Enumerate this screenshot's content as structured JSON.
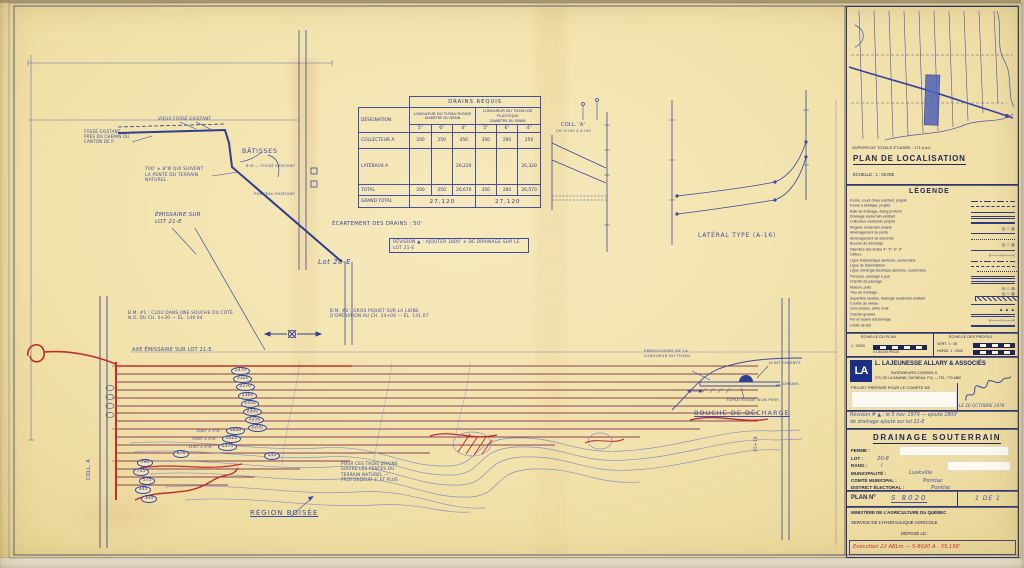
{
  "locator": {
    "superficie": "SUPERFICIE TOTALE ÉTUDIÉE : 171.4 AC.",
    "title": "PLAN DE LOCALISATION",
    "echelle": "ÉCHELLE : 1 : 50,000"
  },
  "legend": {
    "title": "LÉGENDE",
    "items": [
      {
        "label": "Fossé, cours d'eau existant, projeté",
        "symbol": "dashdot"
      },
      {
        "label": "Fossé à déblayer, projeté",
        "symbol": "dash"
      },
      {
        "label": "Raie de drainage, étang profond",
        "symbol": "solid"
      },
      {
        "label": "Drainage souterrain existant",
        "symbol": "double"
      },
      {
        "label": "Collecteur souterrain projeté",
        "symbol": "thick"
      },
      {
        "label": "Regard, souterrain projeté",
        "symbol": "circles"
      },
      {
        "label": "Aménagement de pente",
        "symbol": "solid"
      },
      {
        "label": "Aménagement de descente",
        "symbol": "dot"
      },
      {
        "label": "Bouche de décharge",
        "symbol": "circles"
      },
      {
        "label": "Diamètre des drains 4\", 5\", 6\", 8\"",
        "symbol": "solid"
      },
      {
        "label": "Clôture",
        "symbol": "x"
      },
      {
        "label": "Ligne téléphonique aérienne, souterraine",
        "symbol": "dashdot"
      },
      {
        "label": "Ligne de transmission",
        "symbol": "dash"
      },
      {
        "label": "Ligne d'énergie électrique aérienne, souterraine",
        "symbol": "dot"
      },
      {
        "label": "Ponceau, passage à gué",
        "symbol": "double"
      },
      {
        "label": "Chemin de passage",
        "symbol": "double"
      },
      {
        "label": "Maison, puits",
        "symbol": "circles"
      },
      {
        "label": "Trou de sondage",
        "symbol": "circles"
      },
      {
        "label": "Superficie étudiée, drainage souterrain existant",
        "symbol": "hatch"
      },
      {
        "label": "Courbe de niveau",
        "symbol": "solid"
      },
      {
        "label": "Zone boisée, arbre isolé",
        "symbol": "triangles"
      },
      {
        "label": "Chemin gravelé",
        "symbol": "double"
      },
      {
        "label": "Fer et repère d'arpentage",
        "symbol": "x"
      },
      {
        "label": "Limite de lots",
        "symbol": "thick"
      }
    ]
  },
  "scales": {
    "plan_label": "ÉCHELLE DU PLAN",
    "plan_ratio": "1 : 2000",
    "plan_units": "0     100    200 PIEDS",
    "prof_label": "ÉCHELLE DES PROFILS",
    "vert": "VERT.  1 : 40",
    "horiz": "HORIZ. 1 : 2000"
  },
  "company": {
    "logo": "LA",
    "name": "L. LAJEUNESSE ALLARY & ASSOCIÉS",
    "sub": "INGÉNIEURS CONSEILS",
    "addr": "270, DE LA SAVANE, GATINEAU, P.Q. — TÉL. 770-4880",
    "projet": "PROJET PRÉPARÉ POUR LE COMPTE DE",
    "date": "LE 26 OCTOBRE 1978"
  },
  "revision": {
    "line1": "Révision # ▲ : le 5 nov. 1979 — ajouté 1800'",
    "line2": "de drainage ajouté sur lot 21-E"
  },
  "plan": {
    "title": "DRAINAGE SOUTERRAIN",
    "fields": [
      {
        "label": "FERME :",
        "value": ""
      },
      {
        "label": "LOT :",
        "value": "20-E"
      },
      {
        "label": "RANG :",
        "value": "I"
      },
      {
        "label": "MUNICIPALITÉ :",
        "value": "Luskville"
      },
      {
        "label": "COMTÉ MUNICIPAL :",
        "value": "Pontiac"
      },
      {
        "label": "DISTRICT ÉLECTORAL :",
        "value": "Pontiac"
      }
    ],
    "plan_no_label": "PLAN Nº",
    "plan_no": "S 8020",
    "sheet": "1 DE 1",
    "ministere": "MINISTÈRE DE L'AGRICULTURE DU QUÉBEC",
    "service": "SERVICE DE L'HYDRAULIQUE AGRICOLE",
    "depose": "DÉPOSÉ LE :",
    "exec_note": "Exécution 22 ABLm — S-8020 A :  35,158'"
  },
  "table": {
    "title": "DRAINS REQUIS",
    "designation": "DÉSIGNATION",
    "groups": [
      {
        "label": "LONGUEUR DU TUYAU RIGIDE",
        "diam_label": "DIAMÈTRE DU DRAIN",
        "sizes": [
          "5\"",
          "6\"",
          "4\""
        ]
      },
      {
        "label": "LONGUEUR DU TUYAU DE PLASTIQUE",
        "diam_label": "DIAMÈTRE DU DRAIN",
        "sizes": [
          "5\"",
          "6\"",
          "4\""
        ]
      }
    ],
    "rows": [
      {
        "label": "COLLECTEUR A",
        "values": [
          "200",
          "250",
          "450",
          "350",
          "200",
          "250"
        ]
      },
      {
        "label": "LATÉRAUX A",
        "values": [
          "",
          "",
          "26,220",
          "",
          "",
          "26,320"
        ]
      },
      {
        "label": "TOTAL",
        "values": [
          "200",
          "250",
          "26,670",
          "350",
          "200",
          "26,570"
        ]
      }
    ],
    "grand_total": {
      "label": "GRAND TOTAL",
      "left": "27,120",
      "right": "27,120"
    }
  },
  "notes": {
    "vieux_fosse": "VIEUX FOSSÉ EXISTANT",
    "fosse_chemin": "FOSSÉ EXISTANT PRÈS DU CHEMIN DU CANTON DE P.",
    "batisses": "BÂTISSES",
    "note700": "700' ± 8\"Ø QUI SUIVENT LA PENTE DU TERRAIN NATUREL.",
    "emissaire": "ÉMISSAIRE SUR LOT 21-E",
    "fosse_sm": "8\"Ø — FOSSÉ EXISTANT",
    "ponceau": "PONCEAU EXISTANT",
    "lot20e": "Lot 20-E",
    "bm1": "B.M. #1 : CLOU DANS UNE SOUCHE DU CÔTÉ N.O. DU CH. 0+30 — ÉL. 149.04",
    "bm2": "B.M. #2 : GROS PIQUET SUR LA LIGNE D'OPÉRATION AU CH. 24+00 — ÉL. 141.07",
    "ecartement": "ÉCARTEMENT DES DRAINS : 50'",
    "revision_box": "RÉVISION ▲ : AJOUTER 1800' ± DE DRAINAGE SUR LE LOT 21-E",
    "axe": "AXE ÉMISSAIRE SUR LOT 21-E",
    "trois_drains": "POUR CES TROIS DRAINS SUIVRE LES PENTES DU TERRAIN NATUREL — PROFONDEUR 3' ET PLUS",
    "region": "RÉGION BOISÉE",
    "coll_a": "COLL. A",
    "station": "35+18"
  },
  "profiles": {
    "coll_title": "COLL. 'A'",
    "coll_range": "CH. 0+00 À 4+50",
    "lateral_title": "LATÉRAL TYPE (A-16)"
  },
  "bouche": {
    "l1": "EMBOUCHURE DE LA LONGUEUR DU TUYAU",
    "l2": "JOINT CIMENTÉ",
    "l3": "DRAINS",
    "l4": "TUYAU RIGIDE NON PERF.",
    "title": "BOUCHE DE DÉCHARGE"
  },
  "field": {
    "cascade": [
      "2370",
      "2320",
      "2270",
      "2360",
      "2350",
      "2300",
      "2250",
      "2200"
    ],
    "prefixed": [
      {
        "prefix": "1400' × 4\"Ø",
        "value": "1850"
      },
      {
        "prefix": "1300' × 4\"Ø",
        "value": "1625"
      },
      {
        "prefix": "1100' × 4\"Ø",
        "value": "1375"
      }
    ],
    "cluster": [
      {
        "value": "790",
        "x": 137,
        "y": 459
      },
      {
        "value": "745",
        "x": 133,
        "y": 468
      },
      {
        "value": "676",
        "x": 173,
        "y": 450
      },
      {
        "value": "575",
        "x": 139,
        "y": 477
      },
      {
        "value": "545",
        "x": 264,
        "y": 452
      },
      {
        "value": "345",
        "x": 135,
        "y": 486
      },
      {
        "value": "300",
        "x": 141,
        "y": 495
      }
    ]
  },
  "colors": {
    "ink": "#3a4aa0",
    "red": "#c23232",
    "drain": "#8a4055",
    "paper": "#f0dfa9"
  }
}
